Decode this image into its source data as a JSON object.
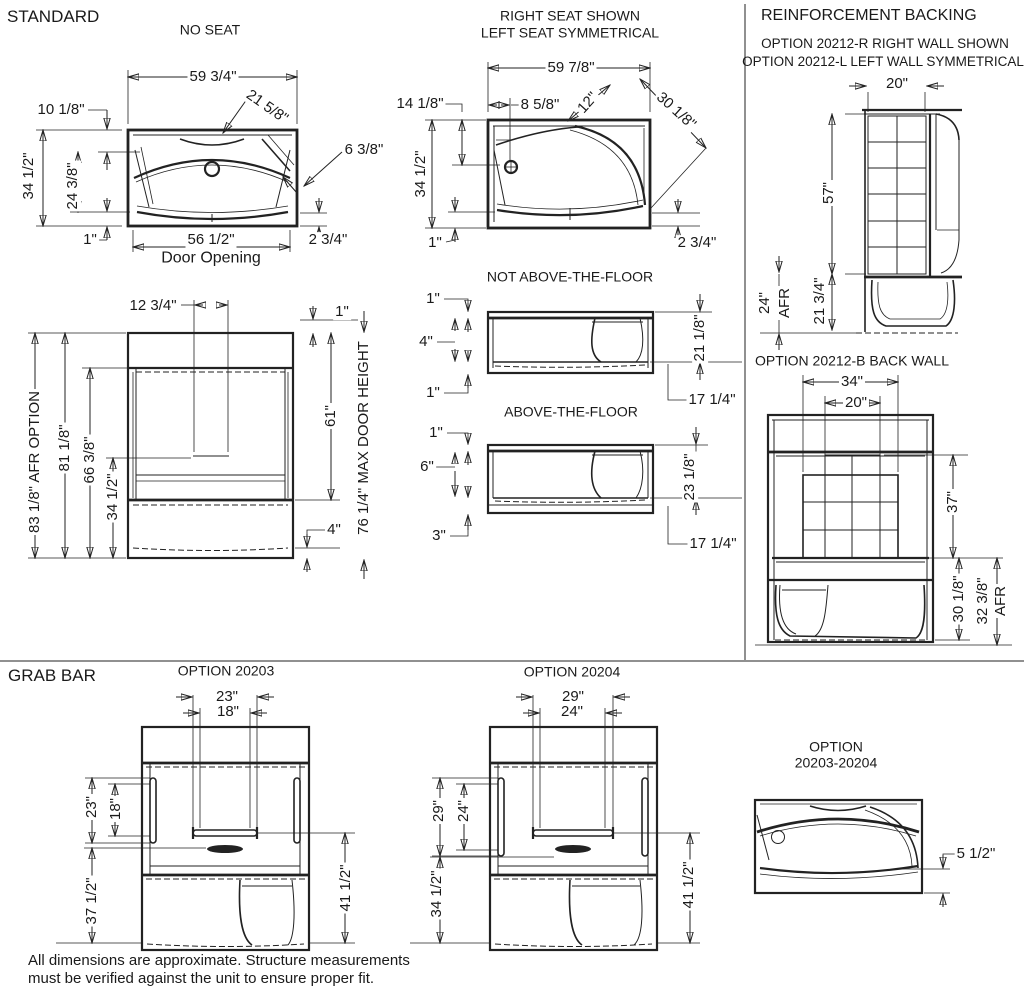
{
  "titles": {
    "standard": "STANDARD",
    "no_seat": "NO SEAT",
    "right_seat_line1": "RIGHT SEAT SHOWN",
    "right_seat_line2": "LEFT SEAT SYMMETRICAL",
    "reinforcement": "REINFORCEMENT BACKING",
    "reinforcement_sub1": "OPTION 20212-R RIGHT WALL SHOWN",
    "reinforcement_sub2": "OPTION 20212-L LEFT WALL SYMMETRICAL",
    "not_above_floor": "NOT ABOVE-THE-FLOOR",
    "above_floor": "ABOVE-THE-FLOOR",
    "back_wall": "OPTION 20212-B BACK WALL",
    "grab_bar": "GRAB BAR",
    "option_20203": "OPTION 20203",
    "option_20204": "OPTION 20204",
    "option_combo_line1": "OPTION",
    "option_combo_line2": "20203-20204"
  },
  "footnote": {
    "line1": "All dimensions are approximate. Structure measurements",
    "line2": "must be verified against the unit to ensure proper fit."
  },
  "dims": {
    "no_seat": {
      "width": "59 3/4\"",
      "seat_corner": "21 5/8\"",
      "rim": "10 1/8\"",
      "corner": "6 3/8\"",
      "depth": "34 1/2\"",
      "inner_depth": "24 3/8\"",
      "lip": "1\"",
      "door_opening": "56 1/2\"",
      "door_opening_label": "Door Opening",
      "apron": "2 3/4\""
    },
    "front": {
      "handle": "12 3/4\"",
      "lip": "1\"",
      "afr": "83 1/8\" AFR OPTION",
      "overall": "81 1/8\"",
      "walls": "66 3/8\"",
      "handle_height": "34 1/2\"",
      "door": "61\"",
      "max_door": "76 1/4\" MAX DOOR HEIGHT",
      "base": "4\""
    },
    "seat_plan": {
      "width": "59 7/8\"",
      "drain": "14 1/8\"",
      "drain_offset": "8 5/8\"",
      "seat": "12\"",
      "seat_diag": "30 1/8\"",
      "depth": "34 1/2\"",
      "lip": "1\"",
      "apron": "2 3/4\""
    },
    "natf": {
      "lip_top": "1\"",
      "base": "4\"",
      "lip_bottom": "1\"",
      "rim": "21 1/8\"",
      "seat": "17 1/4\""
    },
    "atf": {
      "lip_top": "1\"",
      "base": "6\"",
      "bottom": "3\"",
      "rim": "23 1/8\"",
      "seat": "17 1/4\""
    },
    "right_wall": {
      "width": "20\"",
      "height": "57\"",
      "afr": "24\"",
      "afr_label": "AFR",
      "rim": "21 3/4\""
    },
    "back_wall": {
      "width": "34\"",
      "inner_width": "20\"",
      "height": "37\"",
      "rim": "30 1/8\"",
      "afr": "32 3/8\"",
      "afr_label": "AFR"
    },
    "g20203": {
      "top_outer": "23\"",
      "top_inner": "18\"",
      "side_outer": "23\"",
      "side_inner": "18\"",
      "dish": "37 1/2\"",
      "bar": "41 1/2\""
    },
    "g20204": {
      "top_outer": "29\"",
      "top_inner": "24\"",
      "side_outer": "29\"",
      "side_inner": "24\"",
      "dish": "34 1/2\"",
      "bar": "41 1/2\""
    },
    "combo": {
      "apron": "5 1/2\""
    }
  }
}
